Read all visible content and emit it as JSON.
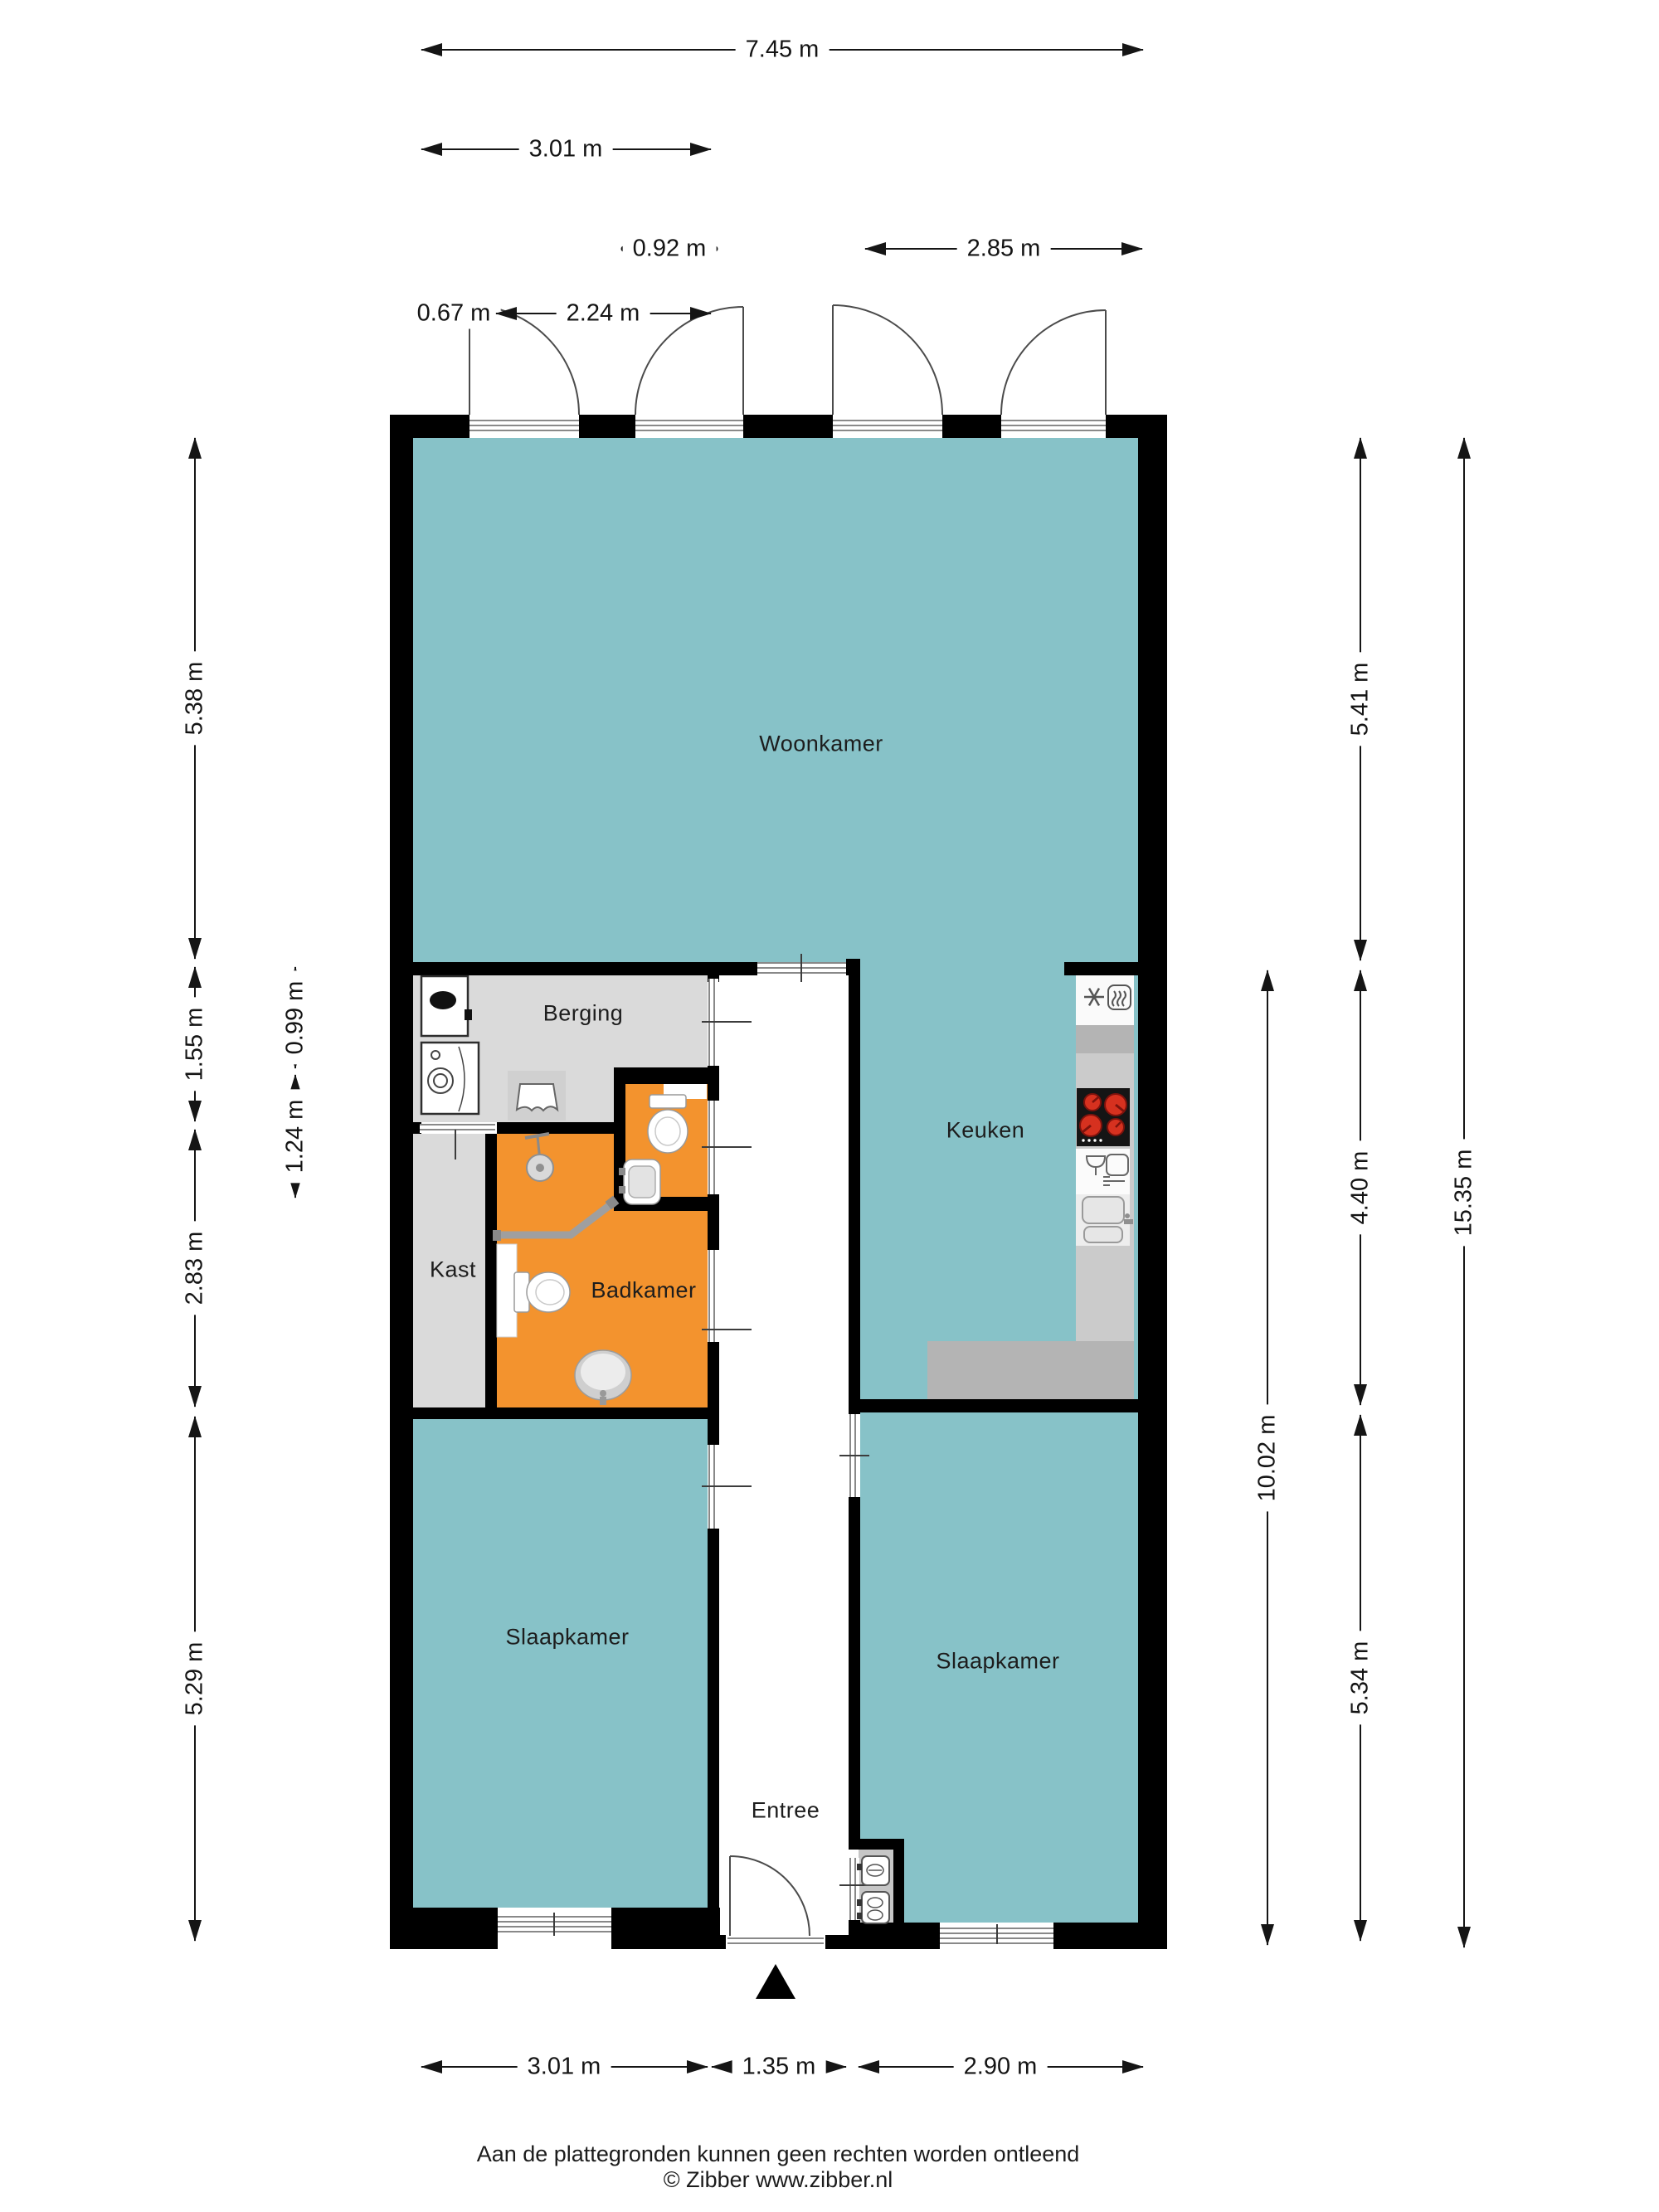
{
  "rooms": {
    "living": "Woonkamer",
    "storage": "Berging",
    "closet": "Kast",
    "bathroom": "Badkamer",
    "kitchen": "Keuken",
    "bedroom_left": "Slaapkamer",
    "bedroom_right": "Slaapkamer",
    "entrance": "Entree"
  },
  "dims": {
    "width_total": "7.45 m",
    "width_left": "3.01 m",
    "width_hall": "0.92 m",
    "width_right": "2.85 m",
    "door_offset": "0.67 m",
    "door_span": "2.24 m",
    "left_living": "5.38 m",
    "left_storage": "1.55 m",
    "left_bath": "2.83 m",
    "left_bedroom": "5.29 m",
    "storage_depth": "0.99 m",
    "toilet_depth": "1.24 m",
    "right_living": "5.41 m",
    "right_kitchen": "4.40 m",
    "right_bedroom": "5.34 m",
    "right_back": "10.02 m",
    "right_total": "15.35 m",
    "bottom_left": "3.01 m",
    "bottom_hall": "1.35 m",
    "bottom_right": "2.90 m"
  },
  "footer": {
    "disclaimer": "Aan de plattegronden kunnen geen rechten worden ontleend",
    "copyright": "© Zibber www.zibber.nl"
  },
  "colors": {
    "room_teal": "#87c2c8",
    "room_orange": "#f3932e",
    "room_gray": "#dadada",
    "wall": "#000000",
    "counter": "#cbcbcb",
    "counter_dark": "#b4b4b4",
    "burner_red": "#d6311f"
  },
  "icons": [
    "boiler-icon",
    "washing-machine-icon",
    "clothes-icon",
    "toilet-icon",
    "hand-basin-icon",
    "shower-icon",
    "shower-rail-icon",
    "washbasin-icon",
    "fridge-icon",
    "oven-icon",
    "cooktop-icon",
    "dishwasher-icon",
    "kitchen-sink-icon",
    "electric-meter-icon",
    "door-swing-icon",
    "north-arrow-icon"
  ]
}
